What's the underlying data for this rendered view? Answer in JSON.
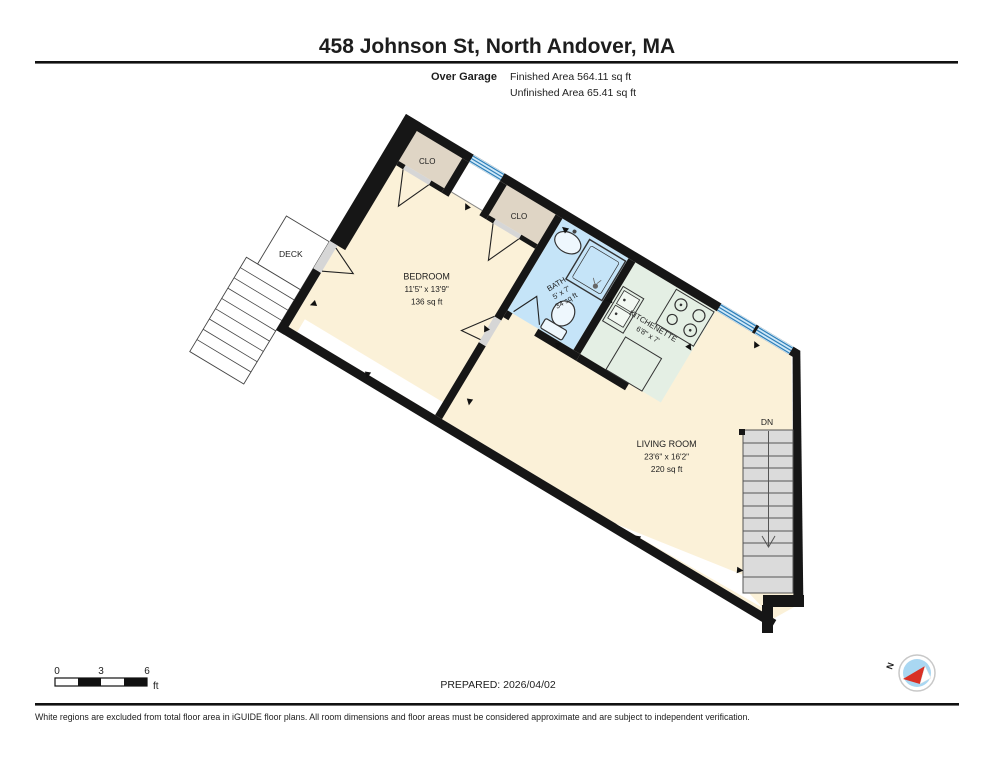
{
  "header": {
    "title": "458 Johnson St, North Andover, MA",
    "floor_label": "Over Garage",
    "finished_area": "Finished Area 564.11 sq ft",
    "unfinished_area": "Unfinished Area 65.41 sq ft"
  },
  "rooms": {
    "bedroom": {
      "name": "BEDROOM",
      "dims": "11'5\" x 13'9\"",
      "area": "136 sq ft"
    },
    "bath": {
      "name": "BATH",
      "dims": "5' x 7'",
      "area": "34 sq ft"
    },
    "kitchenette": {
      "name": "KITCHENETTE",
      "dims": "6'8\" x 7'"
    },
    "living_room": {
      "name": "LIVING ROOM",
      "dims": "23'6\" x 16'2\"",
      "area": "220 sq ft"
    },
    "closet_1": {
      "name": "CLO"
    },
    "closet_2": {
      "name": "CLO"
    },
    "deck": {
      "name": "DECK"
    },
    "stairs_down": {
      "label": "DN"
    }
  },
  "scale_bar": {
    "tick_0": "0",
    "tick_3": "3",
    "tick_6": "6",
    "unit": "ft"
  },
  "compass": {
    "north_label": "N"
  },
  "footer": {
    "prepared": "PREPARED: 2026/04/02",
    "disclaimer": "White regions are excluded from total floor area in iGUIDE floor plans. All room dimensions and floor areas must be considered approximate and are subject to independent verification."
  },
  "colors": {
    "wall": "#161616",
    "floor_fill": "#FBF1D8",
    "closet_fill": "#DFD5C5",
    "bath_fill": "#C5E4F8",
    "kitchen_fill": "#E4EFE4",
    "stairs_fill": "#DBDBDB",
    "window_blue": "#2E7FB8",
    "compass_red": "#D93025"
  }
}
